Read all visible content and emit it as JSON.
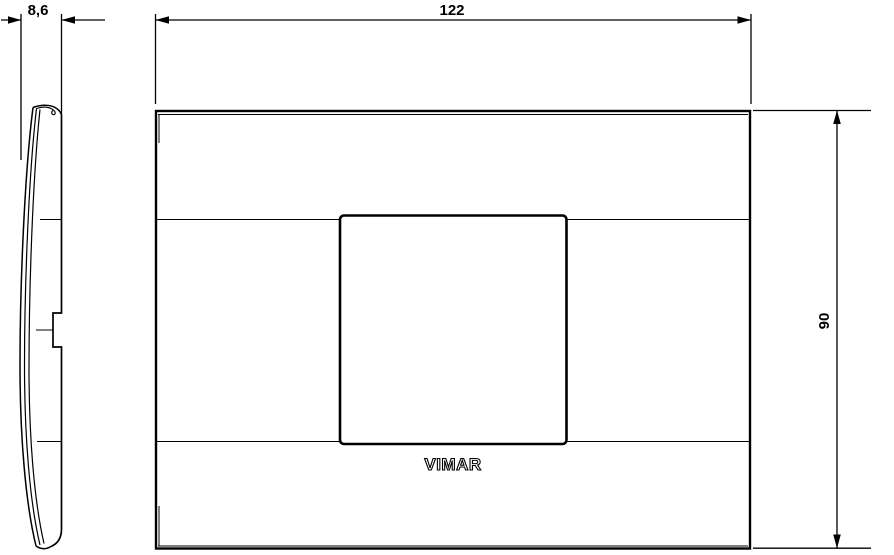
{
  "drawing": {
    "dimensions": {
      "depth": "8,6",
      "width": "122",
      "height": "90"
    },
    "logo": "VIMAR",
    "colors": {
      "line": "#000000",
      "background": "#ffffff"
    }
  }
}
